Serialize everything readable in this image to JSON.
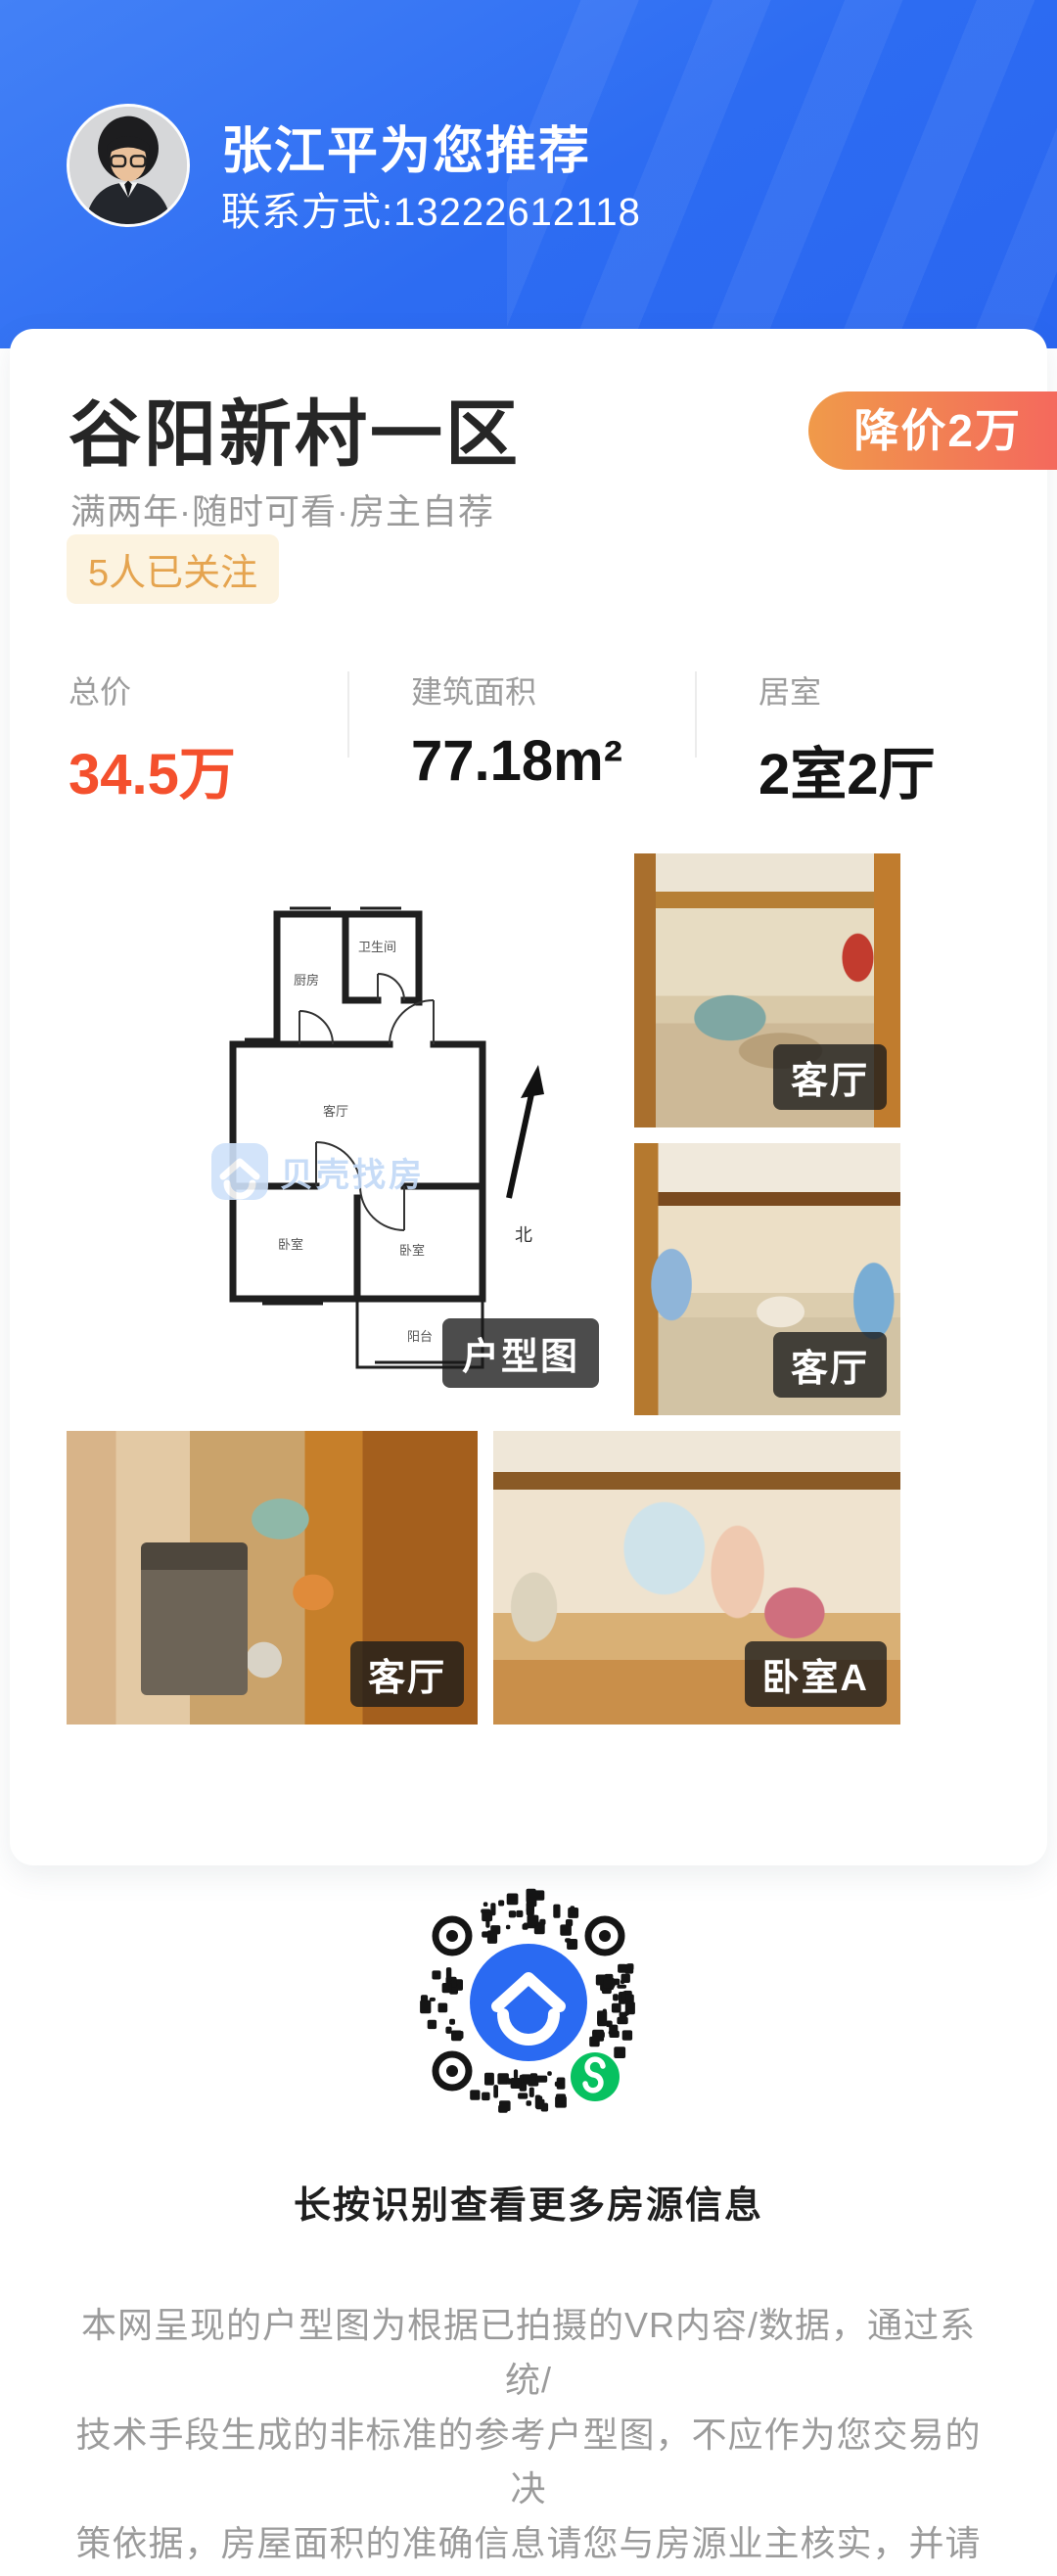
{
  "header": {
    "agent_name_line": "张江平为您推荐",
    "contact_line": "联系方式:13222612118",
    "avatar_alt": "agent-photo"
  },
  "listing": {
    "title": "谷阳新村一区",
    "price_cut_badge": "降价2万",
    "tags_line": "满两年·随时可看·房主自荐",
    "follow_badge": "5人已关注",
    "stats": [
      {
        "label": "总价",
        "value": "34.5万"
      },
      {
        "label": "建筑面积",
        "value": "77.18m²"
      },
      {
        "label": "居室",
        "value": "2室2厅"
      }
    ]
  },
  "photos": {
    "floorplan_tag": "户型图",
    "watermark": "贝壳找房",
    "rooms": [
      "厨房",
      "卫生间",
      "客厅",
      "卧室",
      "卧室",
      "阳台",
      "北"
    ],
    "items": [
      {
        "label": "客厅"
      },
      {
        "label": "客厅"
      },
      {
        "label": "客厅"
      },
      {
        "label": "卧室A"
      }
    ]
  },
  "qr": {
    "caption": "长按识别查看更多房源信息"
  },
  "disclaimer": {
    "lines": [
      "本网呈现的户型图为根据已拍摄的VR内容/数据，通过系统/",
      "技术手段生成的非标准的参考户型图，不应作为您交易的决",
      "策依据，房屋面积的准确信息请您与房源业主核实，并请以",
      "产权证明或您委托的专业机构测量结果为准。"
    ]
  },
  "colors": {
    "header_blue": "#2d6cf2",
    "badge_gradient_start": "#f09a4a",
    "badge_gradient_end": "#f4695d",
    "price_red": "#f4502d",
    "follow_bg": "#fcf3e0",
    "follow_text": "#e5a44f",
    "qr_center_blue": "#2a6af2",
    "wechat_green": "#07c160"
  }
}
